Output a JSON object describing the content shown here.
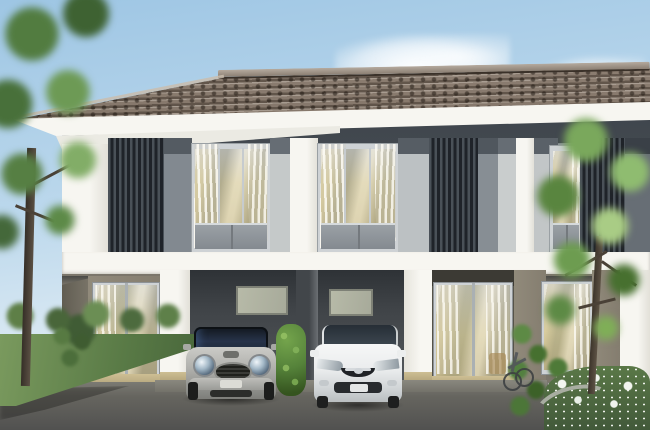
{
  "scene": {
    "type": "architectural-rendering",
    "title": "Modern two-storey townhouse row exterior, daytime",
    "text_visible": "none",
    "objects": {
      "sky": "clear light-blue sky with soft white cloud",
      "roof": "brown tiled hip roof with ridge cap and white fascia",
      "upper_floor": "gray paneled facade with curtained windows, white columns and dark vertical louver screens",
      "slab_band": "white horizontal floor slab between storeys",
      "ground_floor": "taupe walls, glass sliding doors with cream curtains, two dark carport bays with frosted transom windows",
      "car_left": "silver Mini Cooper hatchback parked in left carport",
      "car_right": "white Mazda sedan parked in right carport",
      "shrub_center": "columnar green shrub between carports",
      "hedge_right": "tall hedge with bicycle leaning against it",
      "flowerbed": "curved planter bed of white flowers with gray curb, bottom right",
      "tree_left": "large leafy tree at left edge with lawn and hedge",
      "tree_right": "young tree with bright foliage at right",
      "driveway": "dark asphalt driveway in foreground"
    }
  },
  "palette": {
    "sky-top": "#9ec6e4",
    "sky-bottom": "#e7f0f6",
    "roof-light": "#94867a",
    "roof-dark": "#6d5f52",
    "trim-white": "#f7f6f1",
    "facade-gray": "#8d949a",
    "louver-slat": "#4a5158",
    "louver-dark": "#1f2329",
    "window-frame": "#ced2d5",
    "glass-cream": "#d8cc9e",
    "wall-taupe": "#918a7b",
    "baseboard-tan": "#cdbe93",
    "carport-dark": "#2e3236",
    "frost-glass": "#b7baa8",
    "driveway": "#66655f",
    "grass": "#597a46",
    "hedge": "#55823a",
    "trunk": "#5b5044",
    "mini-silver": "#b1b1ad",
    "car-glass": "#27334a",
    "mazda-white": "#eaeced",
    "flower": "#f3f5f0"
  }
}
